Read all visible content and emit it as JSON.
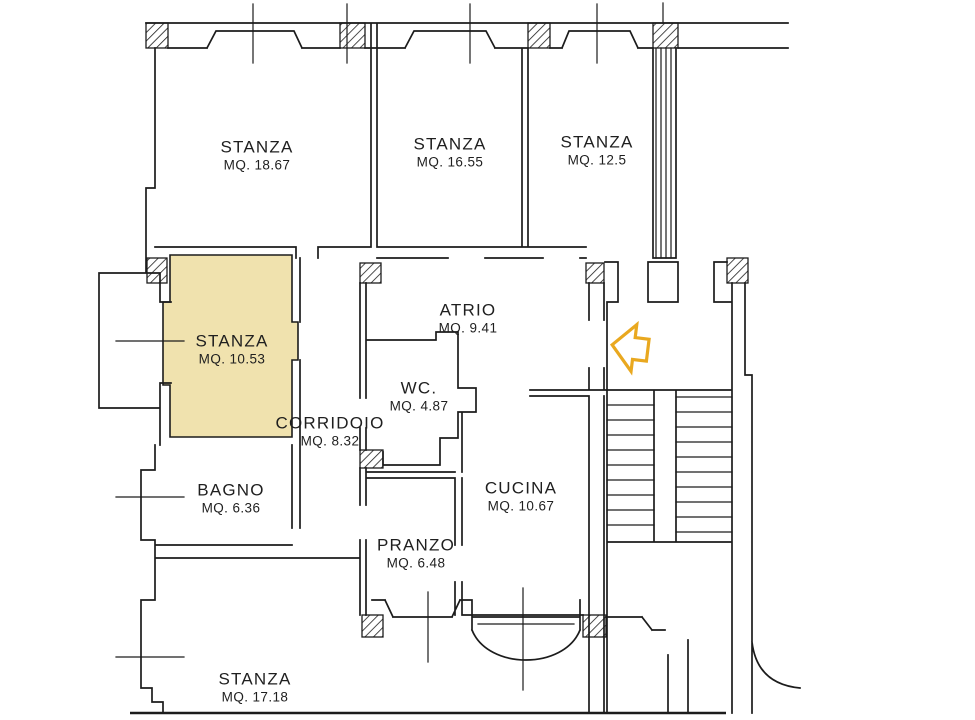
{
  "meta": {
    "type": "architectural-floor-plan",
    "language": "it"
  },
  "colors": {
    "wall": "#1c1c1c",
    "highlight": "#f0e2ae",
    "arrow": "#e9a81f",
    "background": "#ffffff"
  },
  "icons": {
    "entrance_arrow": "left-arrow"
  },
  "rooms": [
    {
      "id": "stanza-nw",
      "name": "STANZA",
      "area": "MQ. 18.67"
    },
    {
      "id": "stanza-n",
      "name": "STANZA",
      "area": "MQ. 16.55"
    },
    {
      "id": "stanza-ne",
      "name": "STANZA",
      "area": "MQ. 12.5"
    },
    {
      "id": "stanza-highlighted",
      "name": "STANZA",
      "area": "MQ. 10.53",
      "highlighted": true
    },
    {
      "id": "atrio",
      "name": "ATRIO",
      "area": "MQ. 9.41"
    },
    {
      "id": "wc",
      "name": "WC.",
      "area": "MQ. 4.87"
    },
    {
      "id": "corridoio",
      "name": "CORRIDOIO",
      "area": "MQ. 8.32"
    },
    {
      "id": "bagno",
      "name": "BAGNO",
      "area": "MQ. 6.36"
    },
    {
      "id": "cucina",
      "name": "CUCINA",
      "area": "MQ. 10.67"
    },
    {
      "id": "pranzo",
      "name": "PRANZO",
      "area": "MQ. 6.48"
    },
    {
      "id": "stanza-s",
      "name": "STANZA",
      "area": "MQ. 17.18"
    }
  ]
}
